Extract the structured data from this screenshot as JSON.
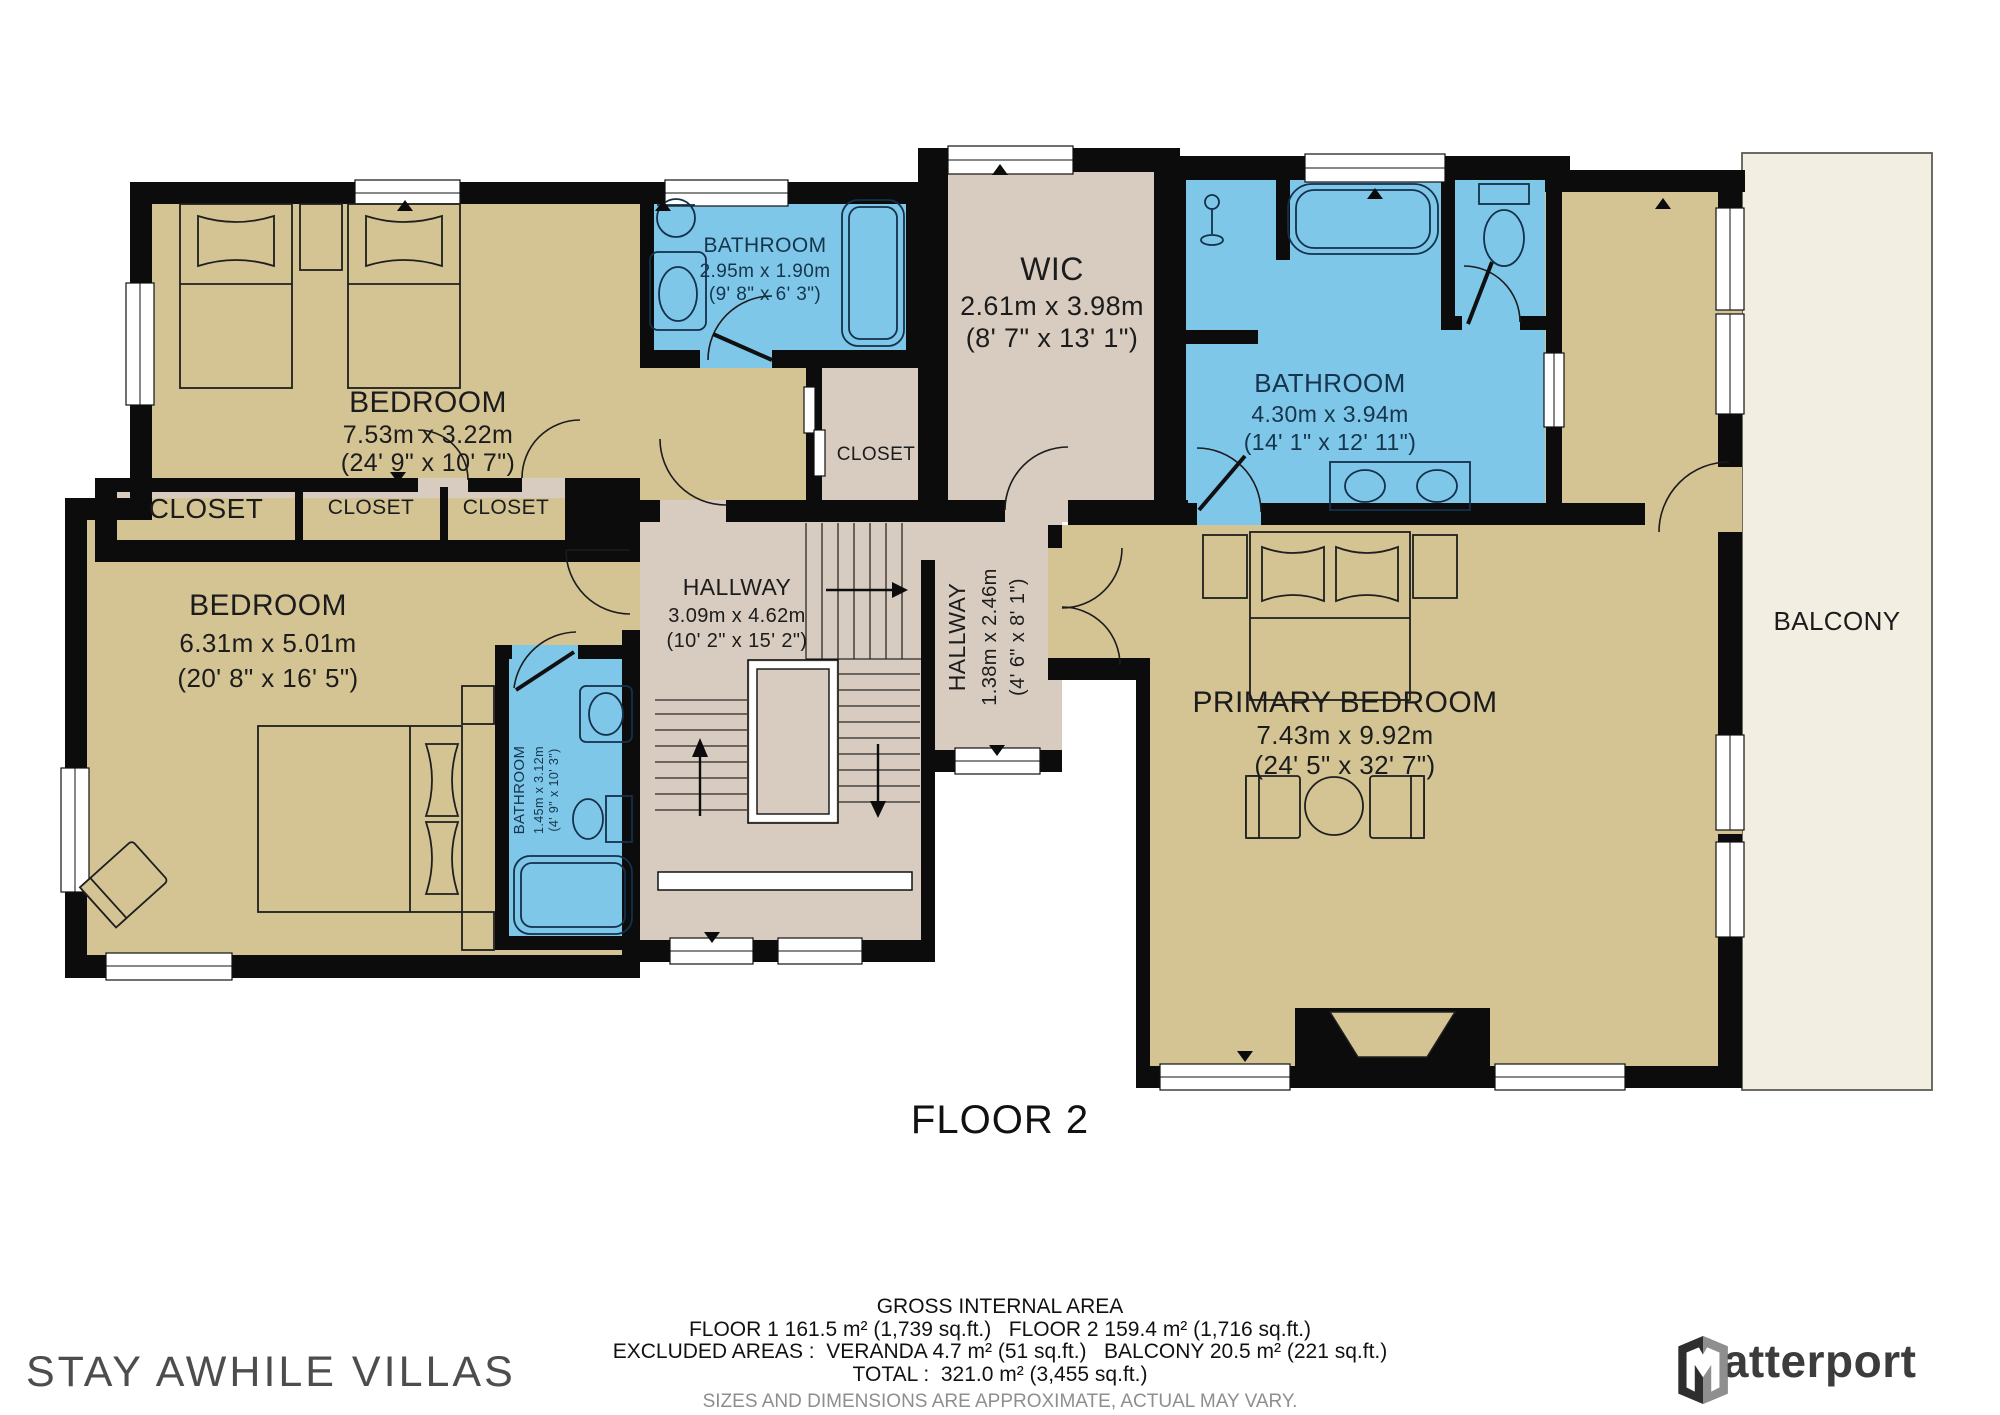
{
  "plan": {
    "floor_label": "FLOOR 2",
    "colors": {
      "room_tan": "#d4c494",
      "room_blue": "#7ec7e9",
      "room_beige": "#d8ccc0",
      "balcony_cream": "#f2eee1",
      "wall": "#0c0c0c",
      "label_text": "#1c1c1c",
      "bath_label_text": "#16354d"
    },
    "rooms": {
      "bedroom_top": {
        "name": "BEDROOM",
        "metric": "7.53m x 3.22m",
        "imperial": "(24' 9\" x 10' 7\")"
      },
      "bathroom_top": {
        "name": "BATHROOM",
        "metric": "2.95m x 1.90m",
        "imperial": "(9' 8\" x 6' 3\")"
      },
      "wic": {
        "name": "WIC",
        "metric": "2.61m x 3.98m",
        "imperial": "(8' 7\" x 13' 1\")"
      },
      "bathroom_main": {
        "name": "BATHROOM",
        "metric": "4.30m x 3.94m",
        "imperial": "(14' 1\" x 12' 11\")"
      },
      "closet_top": {
        "name": "CLOSET"
      },
      "closet_1": {
        "name": "CLOSET"
      },
      "closet_2": {
        "name": "CLOSET"
      },
      "closet_3": {
        "name": "CLOSET"
      },
      "bedroom_left": {
        "name": "BEDROOM",
        "metric": "6.31m x 5.01m",
        "imperial": "(20' 8\" x 16' 5\")"
      },
      "bathroom_small": {
        "name": "BATHROOM",
        "metric": "1.45m x 3.12m",
        "imperial": "(4' 9\" x 10' 3\")"
      },
      "hallway_main": {
        "name": "HALLWAY",
        "metric": "3.09m x 4.62m",
        "imperial": "(10' 2\" x 15' 2\")"
      },
      "hallway_small": {
        "name": "HALLWAY",
        "metric": "1.38m x 2.46m",
        "imperial": "(4' 6\" x 8' 1\")"
      },
      "primary_bedroom": {
        "name": "PRIMARY BEDROOM",
        "metric": "7.43m x 9.92m",
        "imperial": "(24' 5\" x 32' 7\")"
      },
      "balcony": {
        "name": "BALCONY"
      }
    }
  },
  "footer": {
    "title": "GROSS INTERNAL AREA",
    "floors_line": "FLOOR 1 161.5 m² (1,739 sq.ft.)   FLOOR 2 159.4 m² (1,716 sq.ft.)",
    "excluded_line": "EXCLUDED AREAS :  VERANDA 4.7 m² (51 sq.ft.)   BALCONY 20.5 m² (221 sq.ft.)",
    "total_line": "TOTAL :  321.0 m² (3,455 sq.ft.)",
    "disclaimer": "SIZES AND DIMENSIONS ARE APPROXIMATE, ACTUAL MAY VARY."
  },
  "branding": {
    "company": "STAY AWHILE VILLAS",
    "provider": "Matterport"
  }
}
